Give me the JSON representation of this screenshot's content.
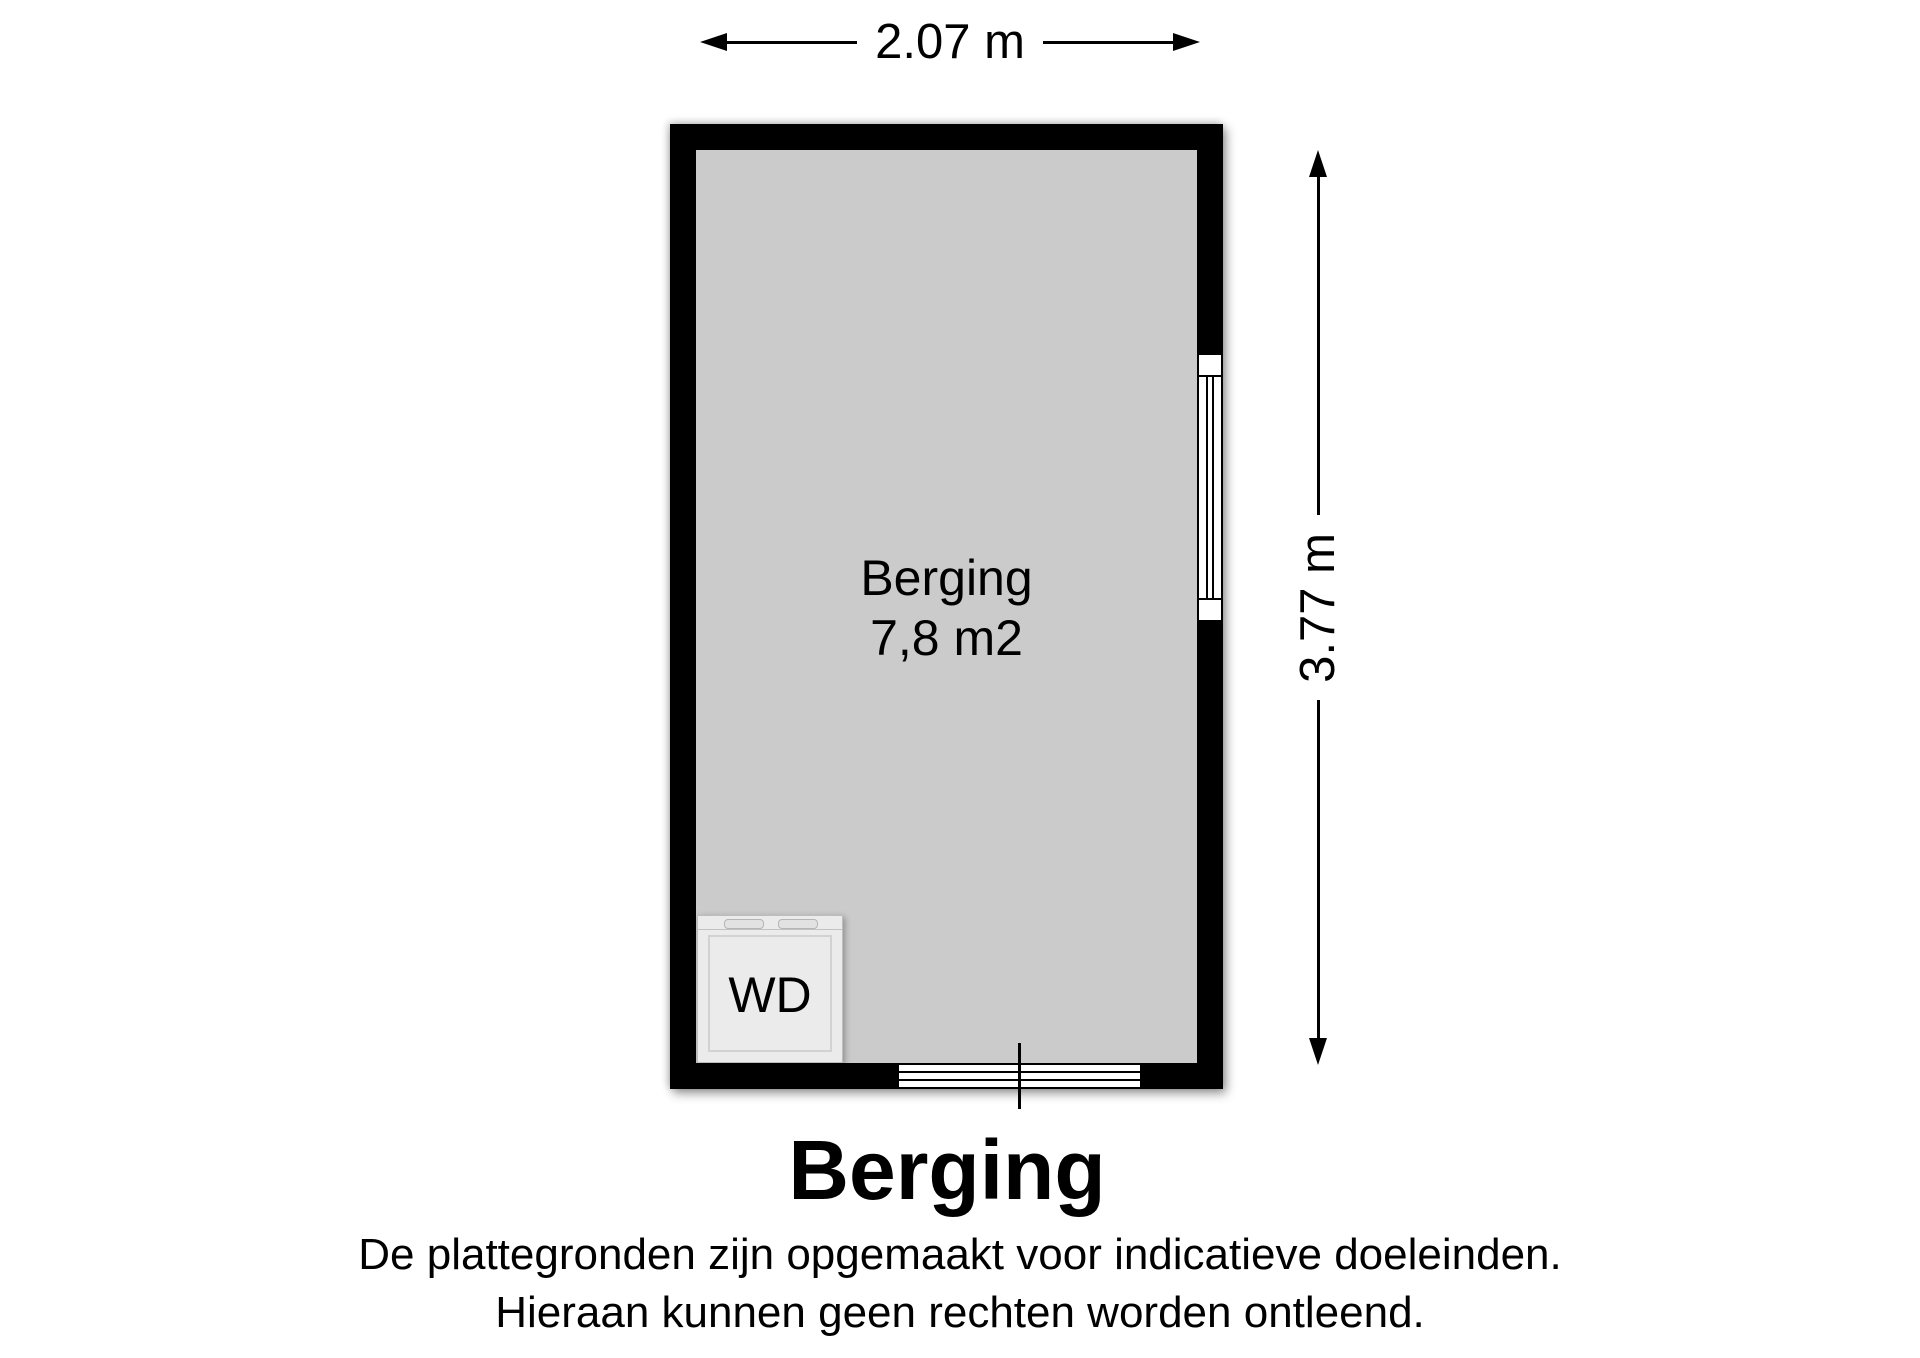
{
  "floorplan": {
    "dimensions": {
      "width_label": "2.07 m",
      "height_label": "3.77 m"
    },
    "room": {
      "name": "Berging",
      "area": "7,8 m2"
    },
    "appliance": {
      "label": "WD"
    },
    "colors": {
      "wall": "#000000",
      "floor": "#cbcbcb",
      "appliance_fill": "#ebebeb",
      "background": "#ffffff"
    }
  },
  "footer": {
    "title": "Berging",
    "disclaimer": [
      "De plattegronden zijn opgemaakt voor indicatieve doeleinden.",
      "Hieraan kunnen geen rechten worden ontleend."
    ]
  }
}
